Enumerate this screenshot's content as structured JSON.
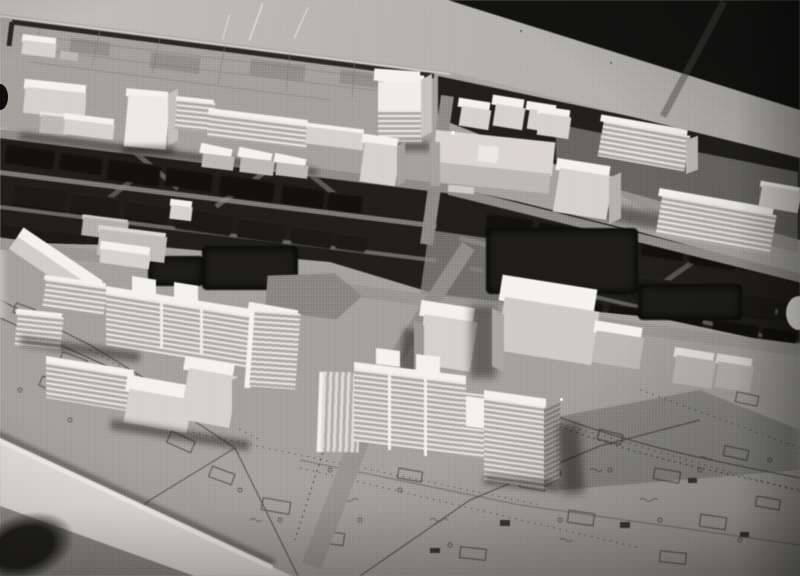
{
  "photo": {
    "type": "black-and-white photograph",
    "subject": "architectural scale model of a modernist city-centre redevelopment masterplan",
    "view": "oblique aerial view of the model lying on a light table against a dark room corner",
    "visible_text": "none legible; the printed map base carries illegible cadastral annotations",
    "elements": {
      "background": "dark room background, top-right corner",
      "table_surface": "light tabletop band along the far edge of the model",
      "model_base": "printed cadastral site plan used as the model base",
      "park_field": "flat gridded park panel along the far edge",
      "far_building_row": "row of white slab and tower blocks along the rear street",
      "boulevard": "central tree-lined boulevard with dark sponge tree blocks and light paths",
      "crossroads": "central street crossing with plaza",
      "foreground_housing": "ribbed multi-storey housing slabs and towers in the foreground",
      "dark_blocks": "dark textured volumes representing dense planting or retained structures",
      "front_edge": "white painted front edge strip of the model base",
      "photo_artifacts": "scratches, dust specks, punch notch at left edge, vignetting"
    },
    "palette": {
      "background_dark": "#161614",
      "table_light": "#b7b5b0",
      "map_base": "#a3a19b",
      "map_linework": "#45433d",
      "building_lit": "#f1efe9",
      "building_face": "#d3d0ca",
      "building_shade": "#a3a09a",
      "tree_dark": "#141310",
      "shadow": "#201f1b",
      "front_edge_white": "#e6e4de"
    }
  }
}
